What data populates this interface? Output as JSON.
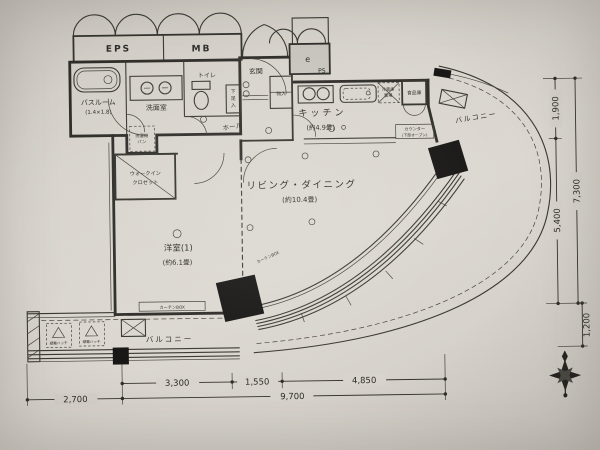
{
  "palette": {
    "paper": "#d7d3cc",
    "ink": "#2f2d29",
    "column": "#181715",
    "box_fill": "#c8c5be"
  },
  "rooms": {
    "living_dining": {
      "name": "リビング・ダイニング",
      "size": "(約10.4畳)"
    },
    "kitchen": {
      "name": "キッチン",
      "size": "(約4.9畳)"
    },
    "western_room": {
      "name": "洋室(1)",
      "size": "(約6.1畳)"
    },
    "bathroom": {
      "name": "バスルーム",
      "size": "(1.4×1.8)"
    },
    "washroom": {
      "name": "洗面室"
    },
    "toilet": {
      "name": "トイレ"
    },
    "entrance": {
      "name": "玄関"
    },
    "hall": {
      "name": "ホール"
    },
    "wic": {
      "line1": "ウォークイン",
      "line2": "クロゼット"
    },
    "balcony_right": {
      "name": "バルコニー"
    },
    "balcony_bottom": {
      "name": "バルコニー"
    }
  },
  "fixtures": {
    "eps": "EPS",
    "mb": "MB",
    "ps": "PS",
    "elec": "e",
    "shoe_chars": [
      "下",
      "足",
      "入"
    ],
    "storage": "物入",
    "pantry": "食品庫",
    "fridge_line1": "冷蔵庫",
    "fridge_line2": "置場",
    "counter_line1": "カウンター",
    "counter_line2": "(下部オープン)",
    "curtain_box_room": "カーテンBOX",
    "curtain_box_living": "カーテンBOX",
    "washer_line1": "洗濯機",
    "washer_line2": "パン",
    "hatch_label": "避難ハッチ"
  },
  "dimensions": {
    "bottom_upper": [
      "3,300",
      "1,550",
      "4,850"
    ],
    "bottom_lower": [
      "2,700",
      "9,700"
    ],
    "right_inner": [
      "1,900",
      "5,400"
    ],
    "right_outer": "7,300",
    "right_bottom": "1,200"
  }
}
